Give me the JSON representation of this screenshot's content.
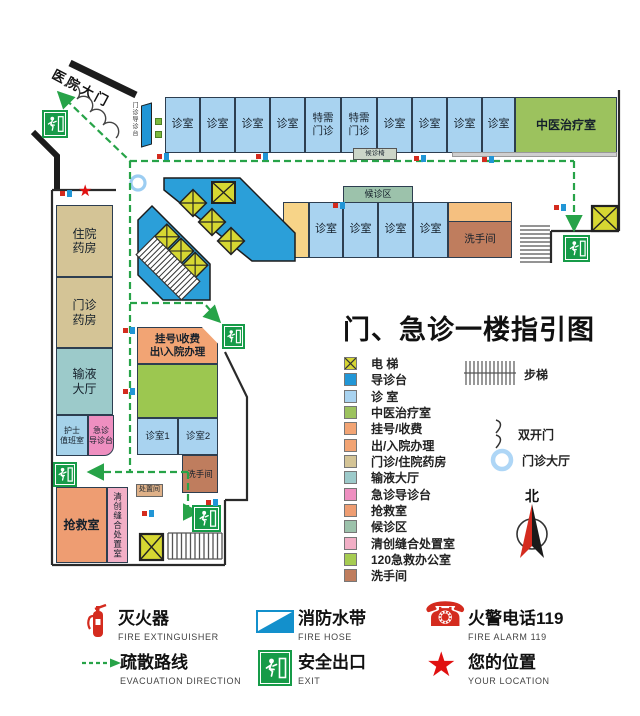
{
  "title": "门、急诊一楼指引图",
  "icons": {
    "star": "★",
    "phone": "☎"
  },
  "map": {
    "entrance_label": "医院大门",
    "entrance_desk": "门诊导诊台",
    "waiting_chairs": "候诊椅",
    "top_rooms": [
      "诊室",
      "诊室",
      "诊室",
      "诊室",
      "特需门诊",
      "特需门诊",
      "诊室",
      "诊室",
      "诊室",
      "诊室",
      "中医治疗室"
    ],
    "row2_waiting": "候诊区",
    "row2_rooms": [
      "诊室",
      "诊室",
      "诊室",
      "诊室"
    ],
    "row2_restroom": "洗手间",
    "inp_l1": "住院",
    "inp_l2": "药房",
    "outp_l1": "门诊",
    "outp_l2": "药房",
    "inf_l1": "输液",
    "inf_l2": "大厅",
    "nurse_l1": "护士",
    "nurse_l2": "值班室",
    "er_desk_l1": "急诊",
    "er_desk_l2": "导诊台",
    "reg_l1": "挂号\\收费",
    "reg_l2": "出\\入院办理",
    "room1": "诊室1",
    "room2": "诊室2",
    "restroom2": "洗手间",
    "rescue": "抢救室",
    "suture": "清创缝合处置室",
    "disposal": "处置间"
  },
  "legend": {
    "items": [
      {
        "label": "电 梯",
        "color": "#d6d732"
      },
      {
        "label": "导诊台",
        "color": "#2196d6"
      },
      {
        "label": "诊 室",
        "color": "#a9d3f0"
      },
      {
        "label": "中医治疗室",
        "color": "#9cc25e"
      },
      {
        "label": "挂号/收费",
        "color": "#f2a474"
      },
      {
        "label": "出/入院办理",
        "color": "#f2a474"
      },
      {
        "label": "门诊/住院药房",
        "color": "#d4c496"
      },
      {
        "label": "输液大厅",
        "color": "#9ccaca"
      },
      {
        "label": "急诊导诊台",
        "color": "#ee8fc0"
      },
      {
        "label": "抢救室",
        "color": "#ee9d72"
      },
      {
        "label": "候诊区",
        "color": "#9cc2ab"
      },
      {
        "label": "清创缝合处置室",
        "color": "#f2afc6"
      },
      {
        "label": "120急救办公室",
        "color": "#a6cc52"
      },
      {
        "label": "洗手间",
        "color": "#bf7d5e"
      }
    ],
    "stairs": "步梯",
    "double_door": "双开门",
    "hall": "门诊大厅",
    "north": "北"
  },
  "fire_legend": {
    "extinguisher": {
      "zh": "灭火器",
      "en": "FIRE EXTINGUISHER"
    },
    "hose": {
      "zh": "消防水带",
      "en": "FIRE HOSE"
    },
    "alarm": {
      "zh": "火警电话119",
      "en": "FIRE ALARM 119"
    },
    "evacuation": {
      "zh": "疏散路线",
      "en": "EVACUATION DIRECTION"
    },
    "exit": {
      "zh": "安全出口",
      "en": "EXIT"
    },
    "location": {
      "zh": "您的位置",
      "en": "YOUR LOCATION"
    }
  },
  "colors": {
    "route_green": "#27a348",
    "exit_green": "#169b48",
    "escalator_blue": "#2b9fd9",
    "elevator_yellow": "#d6d732",
    "alarm_red": "#d42b1e"
  }
}
